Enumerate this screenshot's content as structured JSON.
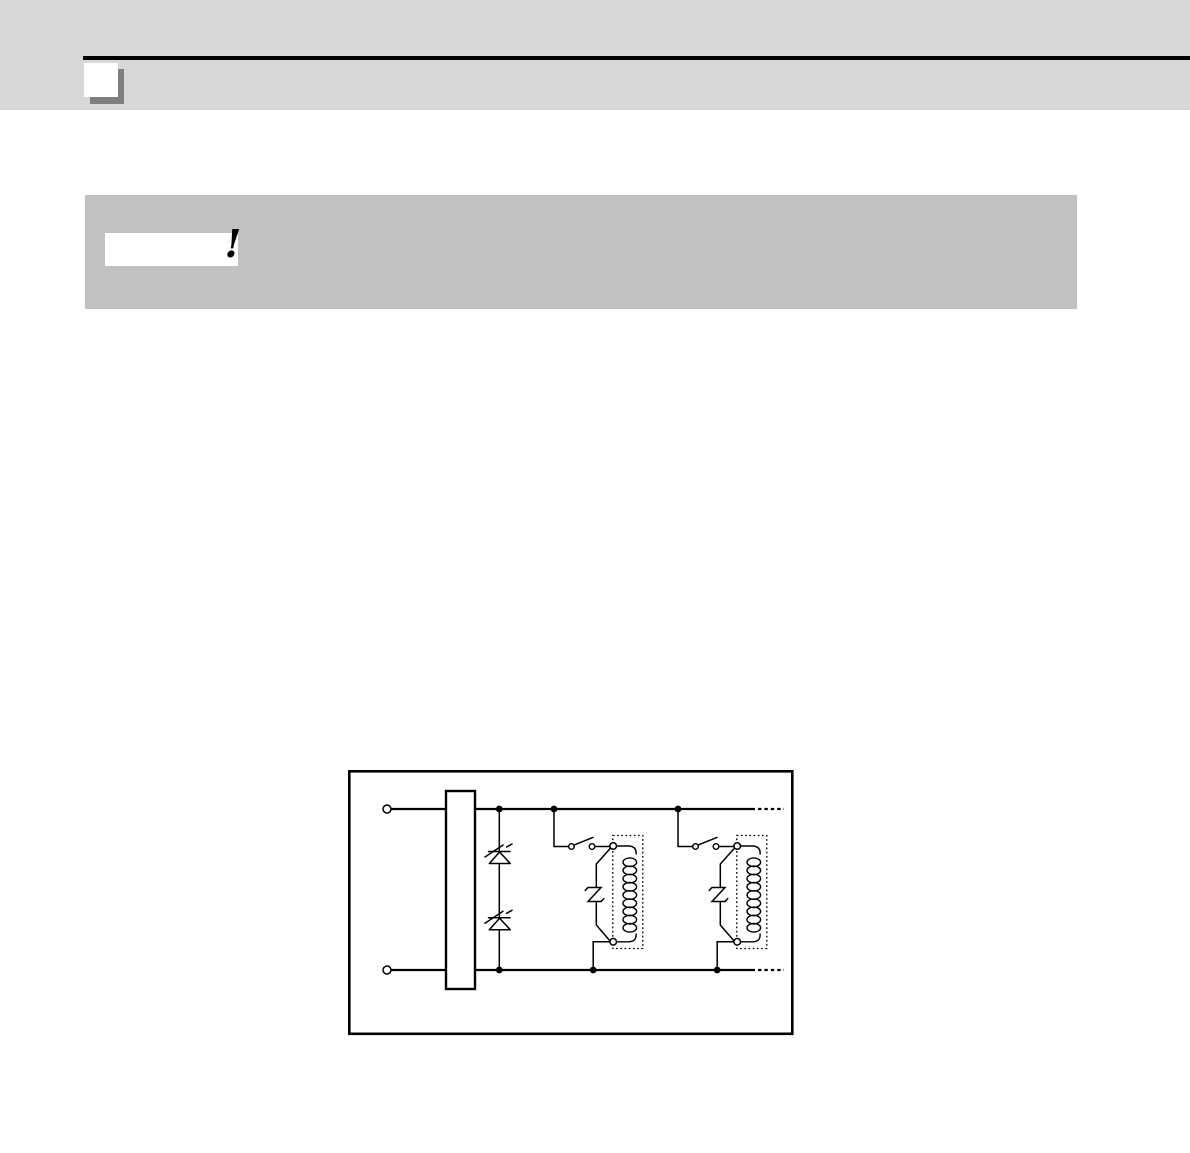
{
  "header": {
    "band_color": "#d8d8d8",
    "rule_color": "#000000",
    "corner_icon": "page-corner-icon",
    "corner_icon_shadow_color": "#7f7f7f"
  },
  "caution": {
    "panel_color": "#c1c1c1",
    "label_box_color": "#ffffff",
    "mark": "!",
    "mark_color": "#000000"
  },
  "diagram": {
    "border_color": "#000000",
    "background": "#ffffff",
    "line_color": "#000000",
    "components": {
      "input_terminals": 2,
      "series_surge_absorbers": 2,
      "relay_units": 2,
      "relay_unit_parts": [
        "contact-switch",
        "parallel-surge-absorber",
        "relay-coil"
      ],
      "continuation_dashes": true
    }
  }
}
